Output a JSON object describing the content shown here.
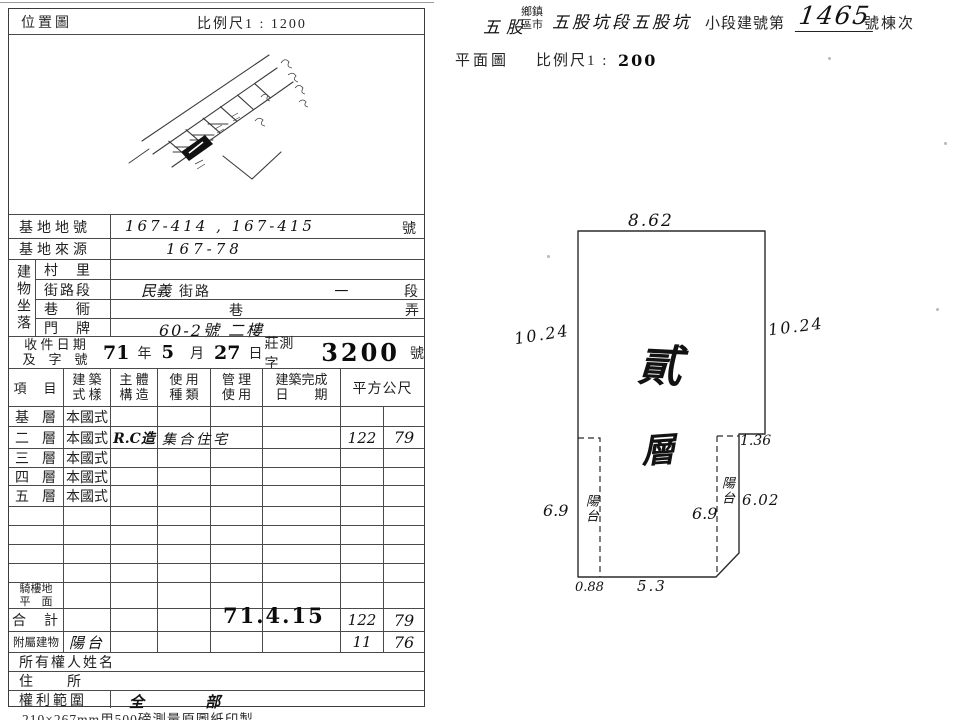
{
  "colors": {
    "paper": "#ffffff",
    "ink": "#1f1f1f",
    "border": "#4a4a4a"
  },
  "location_map": {
    "title": "位置圖",
    "scale": "比例尺1 : 1200"
  },
  "plan_header": {
    "township_value": "五股",
    "township_label_line1": "鄉鎮",
    "township_label_line2": "區市",
    "section_value": "五股坑段五股坑",
    "subsection_label": "小段建號第",
    "building_number": "1465",
    "suffix_label": "號棟次"
  },
  "floor_plan": {
    "title": "平面圖",
    "scale_prefix": "比例尺1 :",
    "scale_value": "200",
    "floor_char1": "貳",
    "floor_char2": "層",
    "balcony_left_label": "陽台",
    "balcony_right_label": "陽台",
    "dim_top": "8.62",
    "dim_left": "10.24",
    "dim_right": "10.24",
    "dim_notch": "1.36",
    "dim_right_lower": "6.02",
    "dim_balcony_left": "6.9",
    "dim_balcony_right": "6.9",
    "dim_bottom_left": "0.88",
    "dim_bottom_mid": "5.3"
  },
  "site": {
    "lot_label": "基地地號",
    "lot_value": "167-414 , 167-415",
    "lot_suffix": "號",
    "origin_label": "基地來源",
    "origin_value": "167-78",
    "location_group": "建物坐落",
    "village_label": "村　里",
    "street_label": "街路段",
    "street_hand": "民義",
    "street_print": "街路",
    "street_section_hand": "一",
    "street_section_print": "段",
    "lane_label": "巷　衕",
    "lane_print": "巷",
    "alley_print": "弄",
    "address_label": "門　牌",
    "address_value": "60-2號 二樓"
  },
  "receipt": {
    "label_line1": "收 件 日 期",
    "label_line2": "及　字　號",
    "year": "71",
    "year_unit": "年",
    "month": "5",
    "month_unit": "月",
    "day": "27",
    "day_unit": "日",
    "word": "莊測字",
    "number": "3200",
    "number_unit": "號"
  },
  "main_table": {
    "headers": {
      "item": "項　目",
      "style_l1": "建 築",
      "style_l2": "式 樣",
      "struct_l1": "主 體",
      "struct_l2": "構 造",
      "use_l1": "使 用",
      "use_l2": "種 類",
      "mgmt_l1": "管 理",
      "mgmt_l2": "使 用",
      "complete_l1": "建築完成",
      "complete_l2": "日　　期",
      "area": "平方公尺"
    },
    "floors": [
      {
        "name": "基",
        "unit": "層",
        "style": "本國式",
        "structure": "",
        "use": "",
        "area_int": "",
        "area_dec": ""
      },
      {
        "name": "二",
        "unit": "層",
        "style": "本國式",
        "structure": "R.C造",
        "use": "集合住宅",
        "area_int": "122",
        "area_dec": "79"
      },
      {
        "name": "三",
        "unit": "層",
        "style": "本國式",
        "structure": "",
        "use": "",
        "area_int": "",
        "area_dec": ""
      },
      {
        "name": "四",
        "unit": "層",
        "style": "本國式",
        "structure": "",
        "use": "",
        "area_int": "",
        "area_dec": ""
      },
      {
        "name": "五",
        "unit": "層",
        "style": "本國式",
        "structure": "",
        "use": "",
        "area_int": "",
        "area_dec": ""
      }
    ],
    "arcade_label_l1": "騎樓地",
    "arcade_label_l2": "平　面",
    "total_label": "合　計",
    "total_stamp": "71.4.15",
    "total_area_int": "122",
    "total_area_dec": "79",
    "annex_label": "附屬建物",
    "annex_value": "陽台",
    "annex_area_int": "11",
    "annex_area_dec": "76",
    "owner_label": "所有權人姓名",
    "address_label": "住　　所",
    "rights_label": "權利範圍",
    "rights_value": "全 部"
  },
  "footer_note": "210×267mm用500磅測量原圖紙印製"
}
